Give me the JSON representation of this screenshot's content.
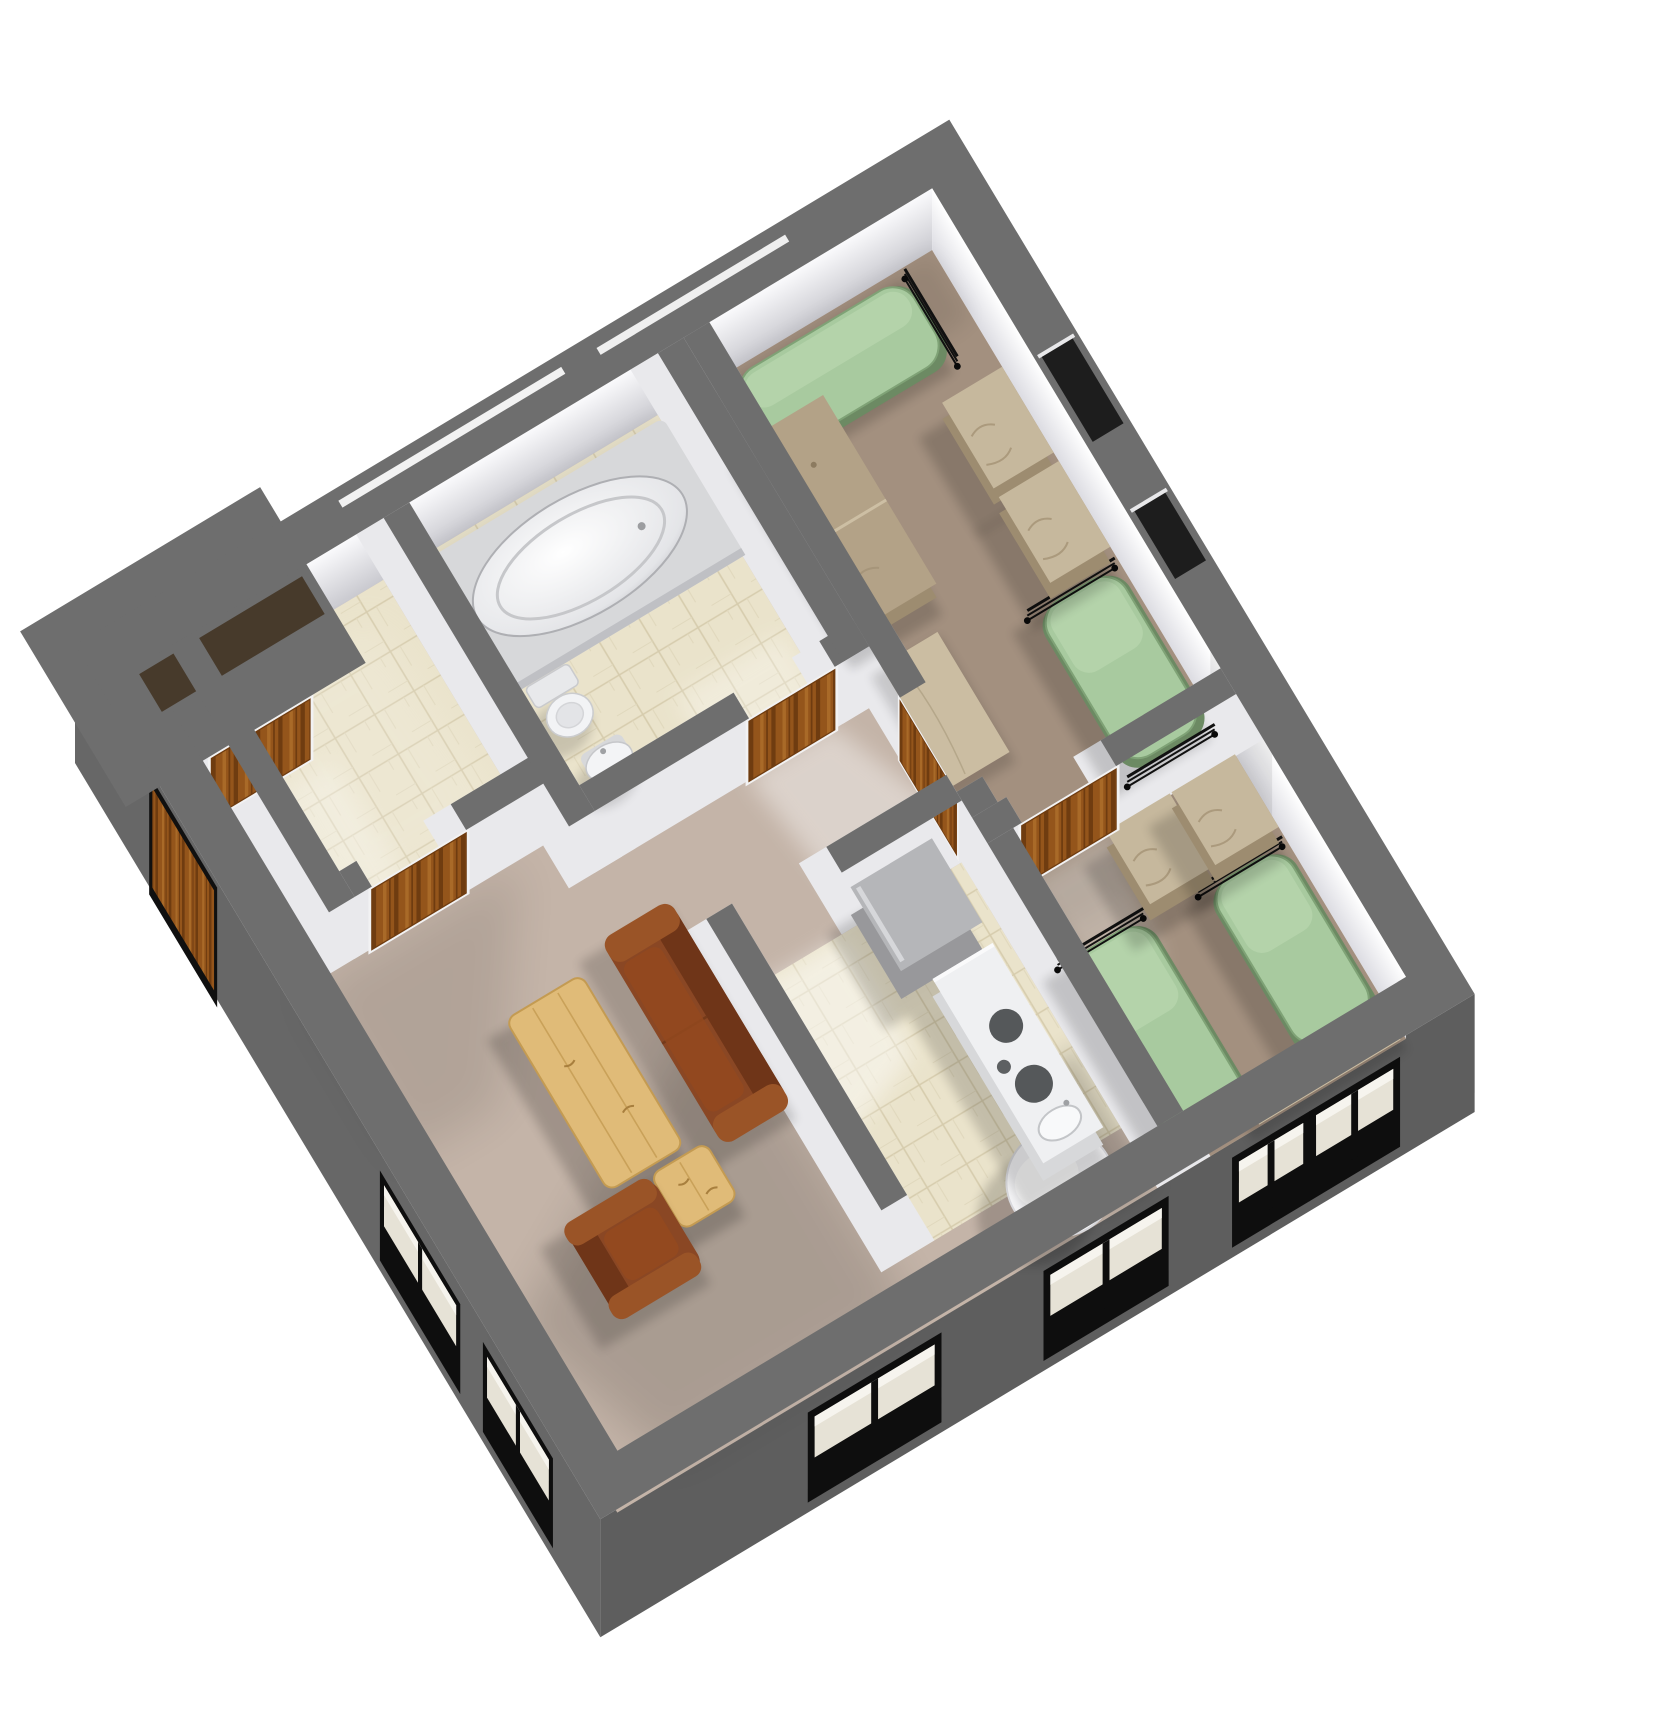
{
  "scene": {
    "canvas": {
      "width": 1677,
      "height": 1711,
      "background": "#ffffff"
    },
    "semantic": {
      "type": "isometric-3d-floor-plan",
      "rooms": [
        "entry-hall",
        "storage-room",
        "bathroom",
        "bedroom-1",
        "bedroom-2",
        "kitchen",
        "living-room",
        "dining-nook"
      ],
      "furniture_inventory": [
        "twin-bed x4",
        "desk x2",
        "dresser x4",
        "desk-plank x2",
        "sofa",
        "armchair",
        "coffee-table",
        "side-table",
        "round-dining-table",
        "refrigerator",
        "kitchen-counter-with-stove-and-sink",
        "bathtub",
        "toilet",
        "bathroom-sink"
      ]
    },
    "projection": {
      "translate": [
        75,
        645
      ],
      "rotate_deg": -31,
      "floor_drop": [
        -32,
        53
      ],
      "vert_dir": [
        -0.515,
        0.857
      ],
      "face_h": 62,
      "skirt_h": 118
    },
    "palette": {
      "wall_top": "#6e6e6e",
      "wall_skirt": "#676767",
      "wall_skirt_dark": "#5e5e5e",
      "face_light": "#f7f7f9",
      "face_mid": "#e9e9ec",
      "face_shade": "#c9c9cf",
      "carpet_living": "#c4b4a8",
      "carpet_bedroom": "#a3907f",
      "tile": "#eae3cb",
      "tile_line": "#d6ccad",
      "bed_green": "#a8ca9f",
      "bed_green_edge": "#7fa276",
      "bed_base": "#6c8a63",
      "tan": "#b3a287",
      "tan_top": "#c6b89d",
      "tan_dark": "#9d8c70",
      "plank": "#cbbda2",
      "wood_door": "#94551b",
      "wood_door_dark": "#6f3c10",
      "sofa": "#8a4724",
      "sofa_dark": "#6f3518",
      "sofa_light": "#9a5427",
      "light_wood": "#e0bb78",
      "light_wood_line": "#c49b52",
      "white_fixture": "#f4f4f6",
      "fixture_gray": "#d7d8da",
      "appliance": "#98989b",
      "appliance_top": "#b5b6b9",
      "window_void": "#0e0e0e",
      "window_frame": "#ded7c2",
      "shadow": "#000000",
      "light": "#ffffff",
      "porch_slot": "#473a2b"
    },
    "walls": {
      "outer_band_path": "M0 0 H1020 V1020 H0 Z M50 50 V970 H970 V50 Z",
      "porch": {
        "rect": [
          -40,
          -40,
          280,
          205
        ],
        "slot": [
          40,
          58,
          190,
          44
        ],
        "slit": [
          300,
          12,
          260,
          8
        ]
      },
      "interior": [
        [
          80,
          50,
          30,
          310
        ],
        [
          110,
          330,
          20,
          30
        ],
        [
          240,
          330,
          120,
          30
        ],
        [
          330,
          50,
          30,
          360
        ],
        [
          360,
          380,
          180,
          30
        ],
        [
          640,
          380,
          40,
          30
        ],
        [
          650,
          50,
          30,
          360
        ],
        [
          680,
          50,
          30,
          420
        ],
        [
          680,
          580,
          30,
          30
        ],
        [
          680,
          610,
          40,
          30
        ],
        [
          830,
          610,
          140,
          30
        ],
        [
          680,
          640,
          30,
          330
        ],
        [
          400,
          560,
          30,
          340
        ],
        [
          540,
          560,
          140,
          30
        ]
      ],
      "ne_slots": [
        [
          977,
          250,
          36,
          100
        ],
        [
          977,
          430,
          36,
          80
        ]
      ],
      "nw_slits": [
        [
          600,
          14,
          220,
          8
        ]
      ]
    },
    "faces": {
      "nw": {
        "at": [
          50,
          50
        ],
        "len": 920
      },
      "ne": {
        "at": [
          970,
          50
        ],
        "len": 920
      }
    },
    "skirts": {
      "sw": {
        "door": [
          150,
          14,
          120,
          100
        ],
        "windows": [
          [
            600,
            26,
            140,
            66
          ],
          [
            800,
            26,
            120,
            66
          ]
        ]
      },
      "se": {
        "windows": [
          [
            250,
            26,
            140,
            66
          ],
          [
            525,
            26,
            130,
            66
          ],
          [
            745,
            26,
            75,
            66
          ],
          [
            835,
            26,
            90,
            66
          ]
        ]
      }
    },
    "floors": [
      {
        "name": "living-room-carpet",
        "kind": "carpet_living",
        "rect": [
          50,
          50,
          920,
          920
        ]
      },
      {
        "name": "bedroom-1-carpet",
        "kind": "carpet_bedroom",
        "rect": [
          710,
          50,
          260,
          560
        ]
      },
      {
        "name": "bedroom-2-carpet",
        "kind": "carpet_bedroom",
        "rect": [
          710,
          640,
          260,
          330
        ]
      },
      {
        "name": "storage-tile",
        "kind": "tile",
        "rect": [
          110,
          50,
          220,
          280
        ]
      },
      {
        "name": "bathroom-tile",
        "kind": "tile",
        "rect": [
          360,
          50,
          290,
          330
        ]
      },
      {
        "name": "kitchen-tile",
        "kind": "tile",
        "rect": [
          430,
          590,
          250,
          310
        ]
      }
    ],
    "shadows": [
      {
        "pts": [
          [
            408,
            570
          ],
          [
            408,
            950
          ],
          [
            120,
            950
          ],
          [
            58,
            760
          ]
        ],
        "a": 0.13,
        "blur": "big"
      },
      {
        "pts": [
          [
            52,
            362
          ],
          [
            300,
            362
          ],
          [
            160,
            560
          ],
          [
            52,
            560
          ]
        ],
        "a": 0.09,
        "blur": "big"
      },
      {
        "pts": [
          [
            612,
            850
          ],
          [
            680,
            800
          ],
          [
            680,
            965
          ],
          [
            612,
            965
          ]
        ],
        "a": 0.2,
        "blur": "med"
      },
      {
        "pts": [
          [
            712,
            52
          ],
          [
            968,
            52
          ],
          [
            968,
            128
          ],
          [
            712,
            128
          ]
        ],
        "a": 0.08,
        "blur": "med"
      },
      {
        "pts": [
          [
            712,
            642
          ],
          [
            968,
            642
          ],
          [
            968,
            700
          ],
          [
            712,
            700
          ]
        ],
        "a": 0.07,
        "blur": "med"
      },
      {
        "pts": [
          [
            362,
            52
          ],
          [
            650,
            52
          ],
          [
            650,
            120
          ],
          [
            362,
            120
          ]
        ],
        "a": 0.08,
        "blur": "med"
      }
    ],
    "lights": [
      {
        "pts": [
          [
            540,
            406
          ],
          [
            640,
            406
          ],
          [
            700,
            560
          ],
          [
            560,
            560
          ]
        ],
        "a": 0.4,
        "blur": "med"
      },
      {
        "pts": [
          [
            432,
            592
          ],
          [
            540,
            592
          ],
          [
            540,
            730
          ],
          [
            432,
            770
          ]
        ],
        "a": 0.45,
        "blur": "med"
      },
      {
        "pts": [
          [
            722,
            642
          ],
          [
            828,
            642
          ],
          [
            800,
            780
          ],
          [
            738,
            780
          ]
        ],
        "a": 0.3,
        "blur": "med"
      },
      {
        "pts": [
          [
            520,
            300
          ],
          [
            645,
            300
          ],
          [
            645,
            378
          ],
          [
            520,
            378
          ]
        ],
        "a": 0.3,
        "blur": "med"
      },
      {
        "pts": [
          [
            130,
            80
          ],
          [
            300,
            80
          ],
          [
            320,
            320
          ],
          [
            130,
            320
          ]
        ],
        "a": 0.15,
        "blur": "big"
      },
      {
        "pts": [
          [
            85,
            180
          ],
          [
            195,
            180
          ],
          [
            195,
            330
          ],
          [
            85,
            330
          ]
        ],
        "a": 0.25,
        "blur": "med"
      }
    ],
    "doors": [
      {
        "name": "entry-door",
        "face": "S",
        "at": [
          60,
          165
        ],
        "len": 115
      },
      {
        "name": "storage-door",
        "face": "S",
        "at": [
          130,
          360
        ],
        "len": 110
      },
      {
        "name": "bathroom-door",
        "face": "S",
        "at": [
          540,
          410
        ],
        "len": 100
      },
      {
        "name": "bedroom-1-door",
        "face": "W",
        "at": [
          680,
          470
        ],
        "len": 110
      },
      {
        "name": "bedroom-2-door",
        "face": "S",
        "at": [
          720,
          640
        ],
        "len": 110
      }
    ],
    "furniture": [
      {
        "name": "bed-1a",
        "t": "bed",
        "r": [
          730,
          58,
          200,
          90
        ],
        "o": "h"
      },
      {
        "name": "bed-1b",
        "t": "bed",
        "r": [
          872,
          415,
          90,
          180
        ],
        "o": "v"
      },
      {
        "name": "bed-2a",
        "t": "bed",
        "r": [
          718,
          730,
          88,
          212
        ],
        "o": "v"
      },
      {
        "name": "bed-2b",
        "t": "bed",
        "r": [
          876,
          740,
          86,
          190
        ],
        "o": "v"
      },
      {
        "name": "desk-bedroom-1",
        "t": "desk",
        "r": [
          715,
          130,
          80,
          220
        ]
      },
      {
        "name": "plank-bedroom-1",
        "t": "plank",
        "r": [
          712,
          380,
          66,
          140
        ]
      },
      {
        "name": "dresser-1a",
        "t": "dresser",
        "r": [
          892,
          200,
          70,
          100
        ]
      },
      {
        "name": "dresser-1b",
        "t": "dresser",
        "r": [
          892,
          310,
          70,
          100
        ]
      },
      {
        "name": "dresser-2a",
        "t": "dresser",
        "r": [
          812,
          652,
          74,
          85
        ]
      },
      {
        "name": "dresser-2b",
        "t": "dresser",
        "r": [
          888,
          652,
          74,
          85
        ]
      },
      {
        "name": "desk-plank-bedroom-2",
        "t": "plank",
        "r": [
          800,
          940,
          165,
          28
        ]
      },
      {
        "name": "sofa",
        "t": "sofa",
        "r": [
          330,
          475,
          80,
          232
        ]
      },
      {
        "name": "coffee-table",
        "t": "woodtable",
        "r": [
          208,
          490,
          88,
          200
        ]
      },
      {
        "name": "side-table",
        "t": "woodtable",
        "r": [
          252,
          698,
          64,
          64
        ]
      },
      {
        "name": "armchair",
        "t": "armchair",
        "r": [
          150,
          700,
          102,
          104
        ]
      },
      {
        "name": "dining-table",
        "t": "round",
        "c": [
          600,
          915
        ],
        "rad": 54
      },
      {
        "name": "refrigerator",
        "t": "fridge",
        "r": [
          558,
          578,
          95,
          98
        ]
      },
      {
        "name": "kitchen-counter",
        "t": "counter",
        "r": [
          586,
          690,
          70,
          215
        ]
      },
      {
        "name": "bathtub",
        "t": "tub",
        "r": [
          368,
          55,
          285,
          160
        ]
      },
      {
        "name": "toilet",
        "t": "toilet",
        "c": [
          420,
          250
        ]
      },
      {
        "name": "bathroom-sink",
        "t": "bathsink",
        "c": [
          430,
          322
        ]
      }
    ]
  }
}
